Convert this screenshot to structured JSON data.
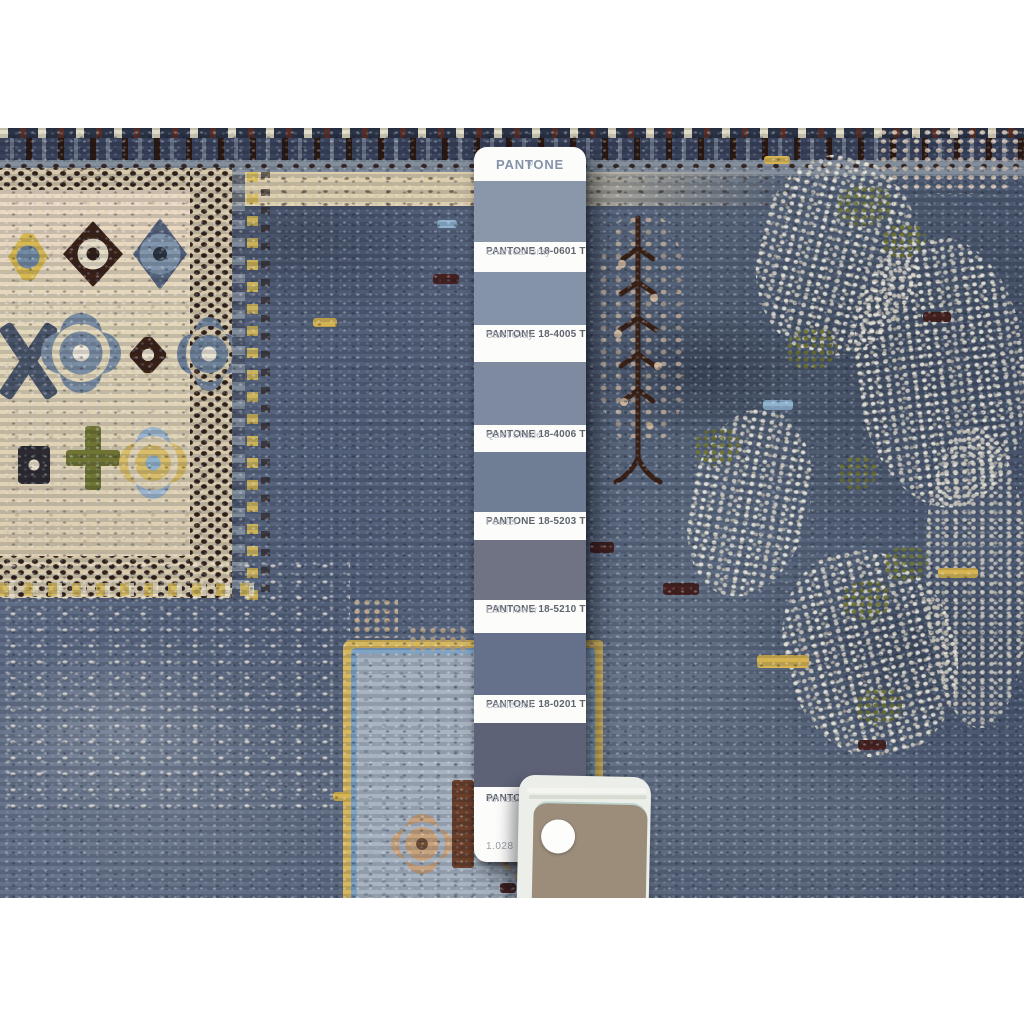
{
  "pantone": {
    "brand": "PANTONE",
    "registered_mark": "®",
    "page_number": "1.028",
    "chips": [
      {
        "code": "PANTONE 18-0601 TPG",
        "name": "Charcoal Gray",
        "color": "#8a96aa"
      },
      {
        "code": "PANTONE 18-4005 TPG",
        "name": "Steel Gray",
        "color": "#8593a9"
      },
      {
        "code": "PANTONE 18-4006 TPG",
        "name": "Quiet Shade",
        "color": "#7d8aa0"
      },
      {
        "code": "PANTONE 18-5203 TPG",
        "name": "Pewter",
        "color": "#6f7d95"
      },
      {
        "code": "PANTONE 18-5210 TPG",
        "name": "Eiffel Tower",
        "color": "#6f7384"
      },
      {
        "code": "PANTONE 18-0201 TPG",
        "name": "Castlerock",
        "color": "#65708a"
      },
      {
        "code": "PANTONE 18-",
        "name": "Tornado",
        "color": "#5d6277"
      }
    ]
  },
  "photo": {
    "palette": {
      "field": "#5f6c80",
      "field_dark": "#3f4b60",
      "field_light": "#93 9dab",
      "ivory": "#e9e4d4",
      "cream": "#e2d6ba",
      "tan": "#c2a98a",
      "gold": "#d7b44f",
      "olive": "#6f7433",
      "brown": "#3a211a",
      "maroon": "#45201e",
      "slate": "#74869e",
      "sky": "#8fb3cf",
      "card_tan": "#9c8d7b",
      "card_edge": "#eceee9"
    }
  }
}
